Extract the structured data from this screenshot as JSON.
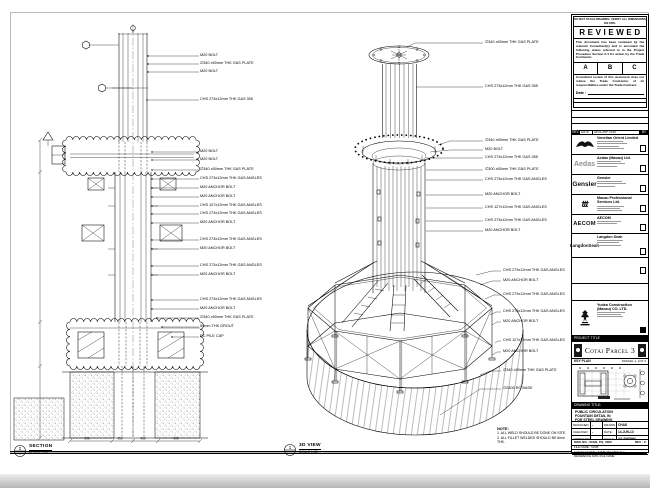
{
  "stamp": {
    "header_note": "DO NOT SCALE DRAWING. VERIFY ALL DIMENSIONS ON SITE.",
    "title": "REVIEWED",
    "body1": "This document has been reviewed by the relevant Consultant(s) and is accorded the following status referred to in the Project Procedure Section 5.4 for action by the Trade Contractor.",
    "options": [
      "A",
      "B",
      "C"
    ],
    "body2": "Consultant review of this document does not relieve the Trade Contractor of its responsibilities under the Trade Contract.",
    "date_label": "Date :"
  },
  "revision_table": {
    "headers": [
      "REV",
      "DATE",
      "DESCRIPTION",
      "BY"
    ]
  },
  "companies": [
    {
      "name": "Venetian Orient Limited"
    },
    {
      "logo_text": "Aedas",
      "name": "Aedas (Macau) Ltd."
    },
    {
      "logo_text": "Gensler",
      "name": "Gensler"
    },
    {
      "logo_text": "ttt",
      "name": "Macau Professional Services Ltd."
    },
    {
      "logo_text": "AECOM",
      "name": "AECOM"
    },
    {
      "logo_text": "LangdonSeah",
      "name": "Langdon Seah"
    }
  ],
  "contractor": {
    "name_line1": "Yudea Construction",
    "name_line2": "(Macau) CO. LTD."
  },
  "project": {
    "label": "PROJECT TITLE",
    "title": "Cotai Parcel 3"
  },
  "key_plan": {
    "label": "KEY PLAN",
    "right_label": "PARCEL 1, LOT 2"
  },
  "title_block": {
    "drawing_title_label": "DRAWING TITLE:",
    "title_lines": [
      "PUBLIC CIRCULATION",
      "FOUNTAIN DETAIL IN",
      "FOR STEEL DRAWING"
    ],
    "designed_label": "DESIGNED",
    "designed": "-",
    "drawn_label": "DRAWN",
    "drawn": "CHAD",
    "checked_label": "CHECKED",
    "checked": "-",
    "date_label": "DATE",
    "date": "14-JUN-13",
    "approved_label": "APPROVED",
    "approved": "-",
    "scale_label": "SCALE",
    "scale": "AS SHOWN",
    "dwg_no_label": "DWG NO :",
    "dwg_no": "515/B_PQ_0000",
    "rev_label": "REV :",
    "rev": "C",
    "file_name_label": "FILE NAME :",
    "file_name": "515/B",
    "cad_file_label": "CAD FILE NAME :",
    "cad_file": "515/B_PQ_0000.dwg",
    "ref_label": "REFERENCE DWG FILE NAME :"
  },
  "left_view": {
    "bubble": "2",
    "bubble_sub": "-",
    "label": "SECTION",
    "scale": "SCALE 1:50",
    "dims": [
      "900",
      "450",
      "450",
      "900"
    ],
    "callouts": [
      "M20 BOLT",
      "∅340 x50mm THK G&S PLATE",
      "M20 BOLT",
      "CHS 273x12mm THK G&S 355",
      "M20 BOLT",
      "M20 BOLT",
      "∅340 x50mm THK G&S PLATE",
      "CHS 273x12mm THK G&S ANGLES",
      "M20 ANCHOR BOLT",
      "M20 ANCHOR BOLT",
      "CHS 127x12mm THK G&S ANGLES",
      "CHS 273x12mm THK G&S ANGLES",
      "M20 ANCHOR BOLT",
      "CHS 273x12mm THK G&S ANGLES",
      "M20 ANCHOR BOLT",
      "CHS 273x12mm THK G&S ANGLES",
      "M20 ANCHOR BOLT",
      "CHS 273x12mm THK G&S ANGLES",
      "M20 ANCHOR BOLT",
      "∅340 x50mm THK G&S PLATE",
      "50mm THK GROUT",
      "RC PILE CAP"
    ]
  },
  "mid_view": {
    "bubble": "1",
    "bubble_sub": "-",
    "label": "3D VIEW",
    "scale": "SCALE 1:50",
    "callouts": [
      "∅340 x50mm THK G&S PLATE",
      "CHS 273x12mm THK G&S 355",
      "∅340 x50mm THK G&S PLATE",
      "M20 BOLT",
      "CHS 273x12mm THK G&S 355",
      "∅300 x50mm THK G&S PLATE",
      "CHS 273x12mm THK G&S ANGLES",
      "M20 ANCHOR BOLT",
      "CHS 127x12mm THK G&S ANGLES",
      "CHS 273x12mm THK G&S ANGLES",
      "M20 ANCHOR BOLT",
      "CHS 273x12mm THK G&S ANGLES",
      "M20 ANCHOR BOLT",
      "CHS 273x12mm THK G&S ANGLES",
      "CHS 273x12mm THK G&S ANGLES",
      "M20 ANCHOR BOLT",
      "CHS 127x12mm THK G&S ANGLES",
      "M20 ANCHOR BOLT",
      "∅340 x50mm THK G&S PLATE",
      "∅2500 RC BASE"
    ]
  },
  "notes": {
    "title": "NOTE:",
    "lines": [
      "1. ALL WELD SHOULD BE DONE ON SITE.",
      "2. ALL FILLET WELDED SHOULD BE 6mm THK."
    ]
  }
}
